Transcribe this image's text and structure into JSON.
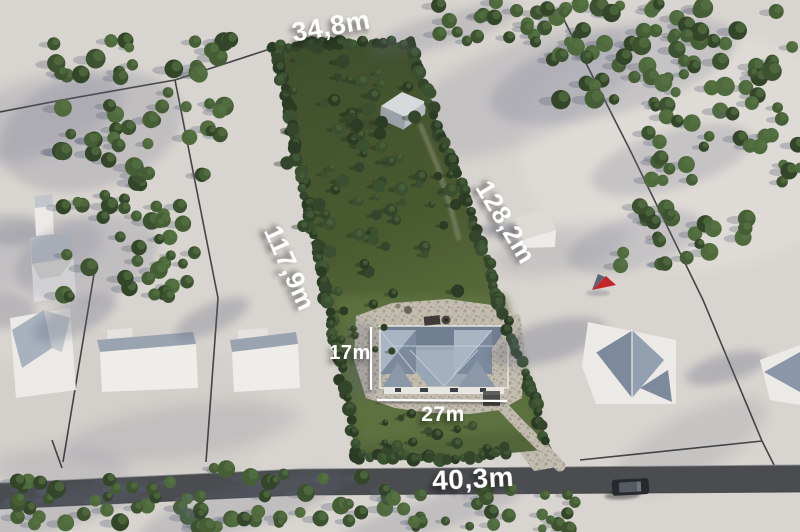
{
  "measurements": {
    "plot_top_width": "34,8m",
    "plot_left_depth": "117,9m",
    "plot_right_depth": "128,2m",
    "house_depth": "17m",
    "house_width": "27m",
    "road_frontage": "40,3m"
  },
  "icons": {
    "marker": "red-location-arrow"
  },
  "colors": {
    "label_text": "#ffffff",
    "marker_red": "#c4252b",
    "marker_dark": "#5c6575",
    "terrain": "#d8d4cf",
    "plot_green": "#4c5d34",
    "roof_blue_gray": "#8a97a8",
    "road_gray": "#4a4c4f"
  }
}
